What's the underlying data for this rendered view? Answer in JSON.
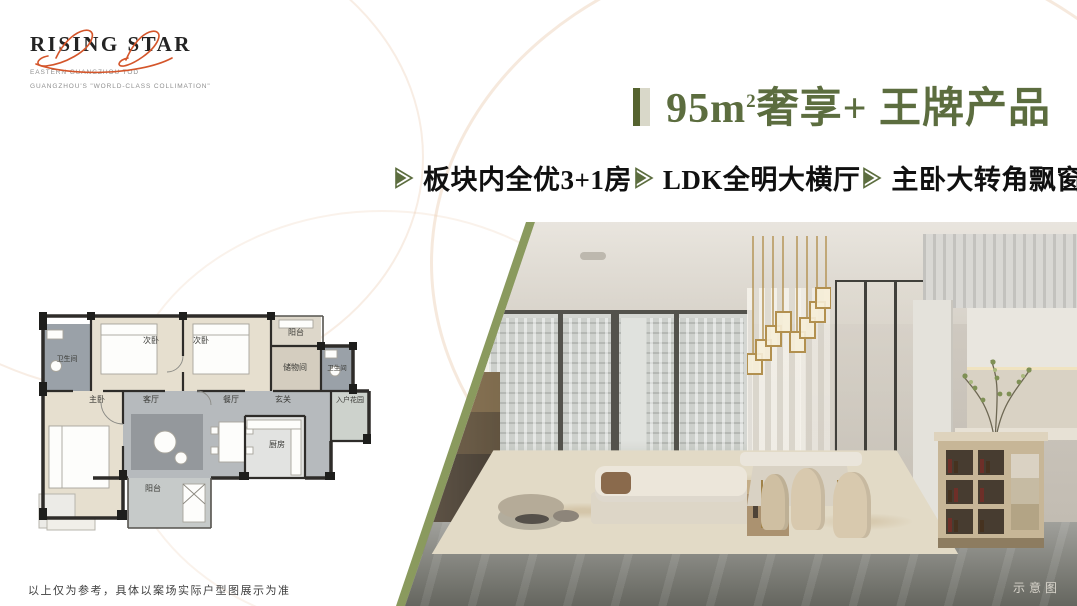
{
  "logo": {
    "title": "RISING STAR",
    "subtitle1": "EASTERN GUANGZHOU TOD",
    "subtitle2": "GUANGZHOU'S \"WORLD-CLASS COLLIMATION\""
  },
  "headline": {
    "part1": "95m",
    "sup": "2",
    "part2": "奢享+ 王牌产品"
  },
  "features": [
    {
      "label": "板块内全优3+1房"
    },
    {
      "label": "LDK全明大横厅"
    },
    {
      "label": "主卧大转角飘窗"
    }
  ],
  "floorplan": {
    "rooms": [
      {
        "label": "卫生间"
      },
      {
        "label": "次卧"
      },
      {
        "label": "次卧"
      },
      {
        "label": "阳台"
      },
      {
        "label": "储物间"
      },
      {
        "label": "卫生间"
      },
      {
        "label": "主卧"
      },
      {
        "label": "客厅"
      },
      {
        "label": "餐厅"
      },
      {
        "label": "玄关"
      },
      {
        "label": "入户花园"
      },
      {
        "label": "厨房"
      },
      {
        "label": "阳台"
      }
    ]
  },
  "photo": {
    "caption": "示意图"
  },
  "footer": {
    "disclaimer": "以上仅为参考，具体以案场实际户型图展示为准"
  },
  "colors": {
    "accent_green": "#5c6d3f",
    "bar_dark": "#55632f",
    "bar_light": "#d9d8c9",
    "edge_olive": "#8a9a5e",
    "script_orange": "#d4552a"
  }
}
